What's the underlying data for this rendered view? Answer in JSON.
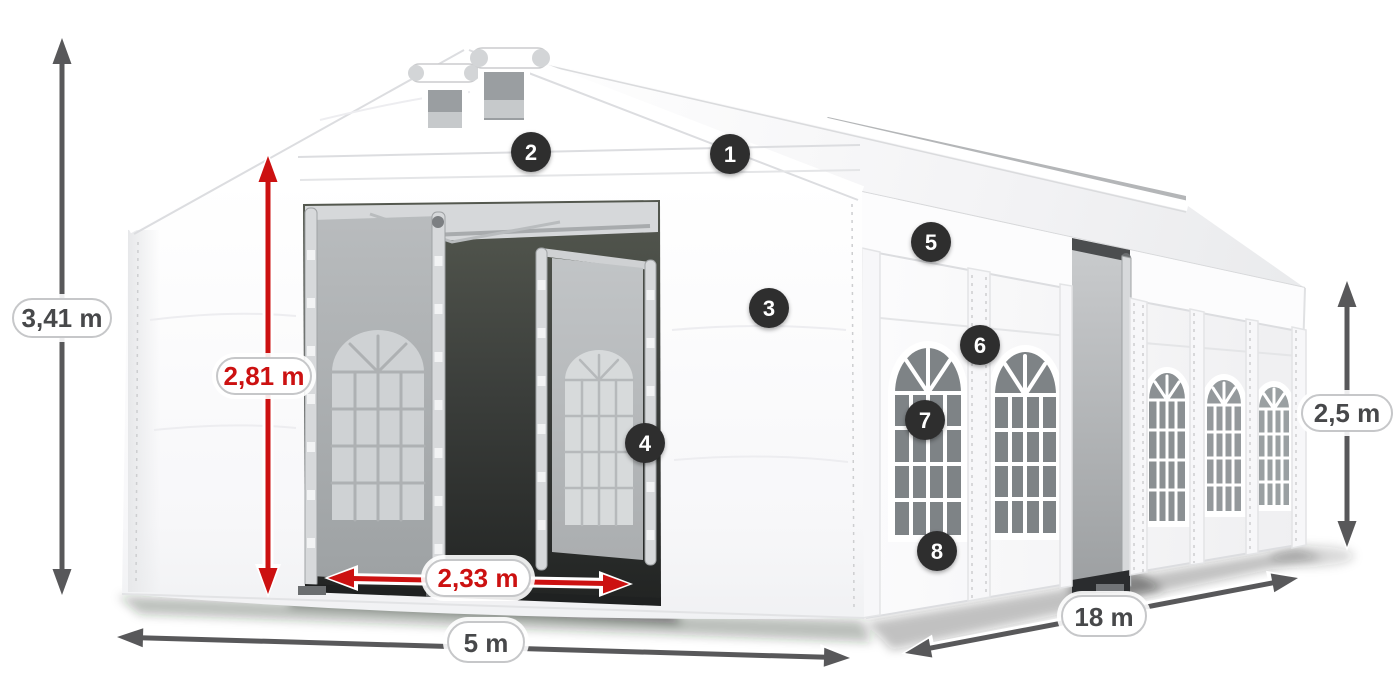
{
  "diagram": {
    "dimensions": {
      "total_height": {
        "value": "3,41 m"
      },
      "entrance_height": {
        "value": "2,81 m"
      },
      "entrance_width": {
        "value": "2,33 m"
      },
      "front_width": {
        "value": "5 m"
      },
      "side_length": {
        "value": "18 m"
      },
      "side_height": {
        "value": "2,5 m"
      }
    },
    "callouts": {
      "c1": "1",
      "c2": "2",
      "c3": "3",
      "c4": "4",
      "c5": "5",
      "c6": "6",
      "c7": "7",
      "c8": "8"
    },
    "colors": {
      "dimension_arrow_gray": "#58585a",
      "dimension_arrow_red": "#cc1111",
      "label_text": "#47484a",
      "label_border": "#c6c7c9",
      "callout_background": "#2d2d2f",
      "callout_text": "#ffffff",
      "tent_fabric": "#ffffff",
      "window_glass": "#7e8386"
    }
  }
}
